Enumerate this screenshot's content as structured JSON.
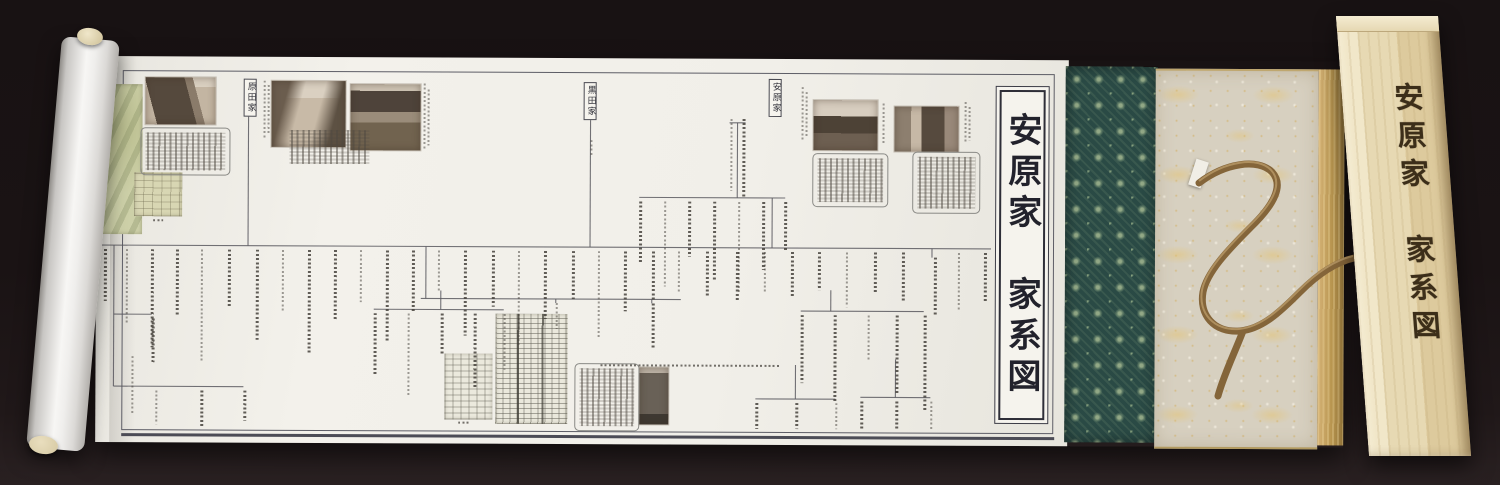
{
  "title_panel": {
    "text": "安原家　家系図"
  },
  "box": {
    "title": "安原家　家系図"
  },
  "family_labels": [
    {
      "id": "harada",
      "text": "原田家"
    },
    {
      "id": "kuroda",
      "text": "黒田家"
    },
    {
      "id": "yasuhara",
      "text": "安原家"
    }
  ],
  "colors": {
    "background": "#1a1314",
    "paper": "#f1efe9",
    "frame_ink": "#5d5d66",
    "brocade_base": "#2a4a45",
    "brocade_motif": "#92a886",
    "gold_cloth": "#d7d0c0",
    "gold_band": "#b8954f",
    "cord": "#8a6a3c",
    "box_wood": "#e7d9b3",
    "calligraphy_ink": "#3c2e19"
  },
  "diagram": {
    "lines": [
      [
        0,
        189,
        895,
        189
      ],
      [
        152,
        57,
        152,
        189
      ],
      [
        494,
        60,
        494,
        189
      ],
      [
        633,
        64,
        649,
        64
      ],
      [
        641,
        64,
        641,
        139
      ],
      [
        543,
        139,
        689,
        139
      ],
      [
        676,
        139,
        676,
        189
      ],
      [
        18,
        189,
        18,
        330
      ],
      [
        18,
        258,
        56,
        258
      ],
      [
        18,
        330,
        148,
        330
      ],
      [
        330,
        189,
        330,
        241
      ],
      [
        325,
        241,
        585,
        241
      ],
      [
        460,
        241,
        460,
        245
      ],
      [
        556,
        241,
        556,
        245
      ],
      [
        345,
        233,
        345,
        252
      ],
      [
        278,
        252,
        408,
        252
      ],
      [
        735,
        231,
        735,
        252
      ],
      [
        705,
        252,
        828,
        252
      ],
      [
        836,
        189,
        836,
        198
      ],
      [
        700,
        306,
        700,
        340
      ],
      [
        660,
        340,
        740,
        340
      ],
      [
        800,
        300,
        800,
        338
      ],
      [
        765,
        338,
        835,
        338
      ]
    ],
    "columns": [
      [
        8,
        193,
        52
      ],
      [
        30,
        193,
        75
      ],
      [
        55,
        193,
        98
      ],
      [
        80,
        193,
        66
      ],
      [
        105,
        193,
        112
      ],
      [
        132,
        193,
        58
      ],
      [
        160,
        193,
        90
      ],
      [
        186,
        193,
        62
      ],
      [
        212,
        193,
        104
      ],
      [
        238,
        193,
        70
      ],
      [
        264,
        193,
        52
      ],
      [
        290,
        193,
        92
      ],
      [
        316,
        193,
        63
      ],
      [
        342,
        193,
        40
      ],
      [
        368,
        193,
        85
      ],
      [
        396,
        193,
        56
      ],
      [
        422,
        193,
        94
      ],
      [
        448,
        193,
        68
      ],
      [
        476,
        193,
        48
      ],
      [
        502,
        193,
        88
      ],
      [
        528,
        193,
        60
      ],
      [
        556,
        193,
        50
      ],
      [
        582,
        193,
        40
      ],
      [
        610,
        193,
        45
      ],
      [
        640,
        193,
        50
      ],
      [
        668,
        193,
        42
      ],
      [
        695,
        193,
        45
      ],
      [
        722,
        193,
        38
      ],
      [
        750,
        193,
        55
      ],
      [
        778,
        193,
        42
      ],
      [
        806,
        193,
        48
      ],
      [
        862,
        193,
        58
      ],
      [
        888,
        193,
        50
      ],
      [
        543,
        143,
        62
      ],
      [
        568,
        143,
        85
      ],
      [
        592,
        143,
        55
      ],
      [
        617,
        143,
        78
      ],
      [
        642,
        143,
        92
      ],
      [
        666,
        143,
        68
      ],
      [
        688,
        143,
        48
      ],
      [
        634,
        60,
        72
      ],
      [
        646,
        60,
        78
      ],
      [
        278,
        256,
        62
      ],
      [
        312,
        256,
        82
      ],
      [
        345,
        256,
        42
      ],
      [
        378,
        256,
        74
      ],
      [
        408,
        256,
        56
      ],
      [
        705,
        256,
        68
      ],
      [
        738,
        256,
        88
      ],
      [
        772,
        256,
        46
      ],
      [
        800,
        256,
        78
      ],
      [
        828,
        256,
        96
      ],
      [
        460,
        245,
        26
      ],
      [
        556,
        245,
        46
      ],
      [
        56,
        262,
        44
      ],
      [
        60,
        334,
        34
      ],
      [
        105,
        334,
        36
      ],
      [
        148,
        334,
        30
      ],
      [
        36,
        300,
        58
      ],
      [
        660,
        344,
        26
      ],
      [
        700,
        344,
        26
      ],
      [
        740,
        344,
        26
      ],
      [
        765,
        342,
        28
      ],
      [
        800,
        342,
        28
      ],
      [
        835,
        342,
        28
      ],
      [
        838,
        198,
        58
      ]
    ],
    "caption_columns": [
      [
        167,
        24,
        58
      ],
      [
        171,
        28,
        50
      ],
      [
        327,
        26,
        66
      ],
      [
        331,
        32,
        56
      ],
      [
        705,
        28,
        54
      ],
      [
        709,
        33,
        46
      ],
      [
        786,
        44,
        40
      ],
      [
        868,
        42,
        40
      ],
      [
        872,
        47,
        34
      ],
      [
        494,
        82,
        16
      ]
    ],
    "hdash": [
      [
        505,
        306,
        180
      ],
      [
        57,
        163,
        10
      ],
      [
        363,
        364,
        12
      ]
    ],
    "blocks": [
      {
        "x": 44,
        "y": 71,
        "w": 80,
        "h": 38,
        "border": true
      },
      {
        "x": 189,
        "y": 69,
        "w": 80,
        "h": 34,
        "border": false
      },
      {
        "x": 716,
        "y": 94,
        "w": 66,
        "h": 44,
        "border": true
      },
      {
        "x": 816,
        "y": 92,
        "w": 58,
        "h": 52,
        "border": true
      },
      {
        "x": 479,
        "y": 305,
        "w": 55,
        "h": 58,
        "border": true
      }
    ],
    "photos": [
      {
        "x": 49,
        "y": 21,
        "w": 70,
        "h": 47,
        "kind": "photo-city"
      },
      {
        "x": 175,
        "y": 24,
        "w": 74,
        "h": 66,
        "kind": "photo-street"
      },
      {
        "x": 254,
        "y": 27,
        "w": 70,
        "h": 66,
        "kind": "photo-temple"
      },
      {
        "x": 717,
        "y": 41,
        "w": 64,
        "h": 50,
        "kind": "photo-townhouse"
      },
      {
        "x": 798,
        "y": 47,
        "w": 64,
        "h": 45,
        "kind": "photo-shop"
      },
      {
        "x": 544,
        "y": 309,
        "w": 29,
        "h": 57,
        "kind": "photo-modern"
      }
    ],
    "maps": [
      {
        "x": 2,
        "y": 28,
        "w": 44,
        "h": 150,
        "kind": "map-green-tall"
      },
      {
        "x": 38,
        "y": 116,
        "w": 48,
        "h": 44,
        "kind": "map-green-square"
      },
      {
        "x": 349,
        "y": 296,
        "w": 48,
        "h": 66,
        "kind": "map-small"
      },
      {
        "x": 400,
        "y": 256,
        "w": 72,
        "h": 110,
        "kind": "map-large"
      }
    ]
  }
}
